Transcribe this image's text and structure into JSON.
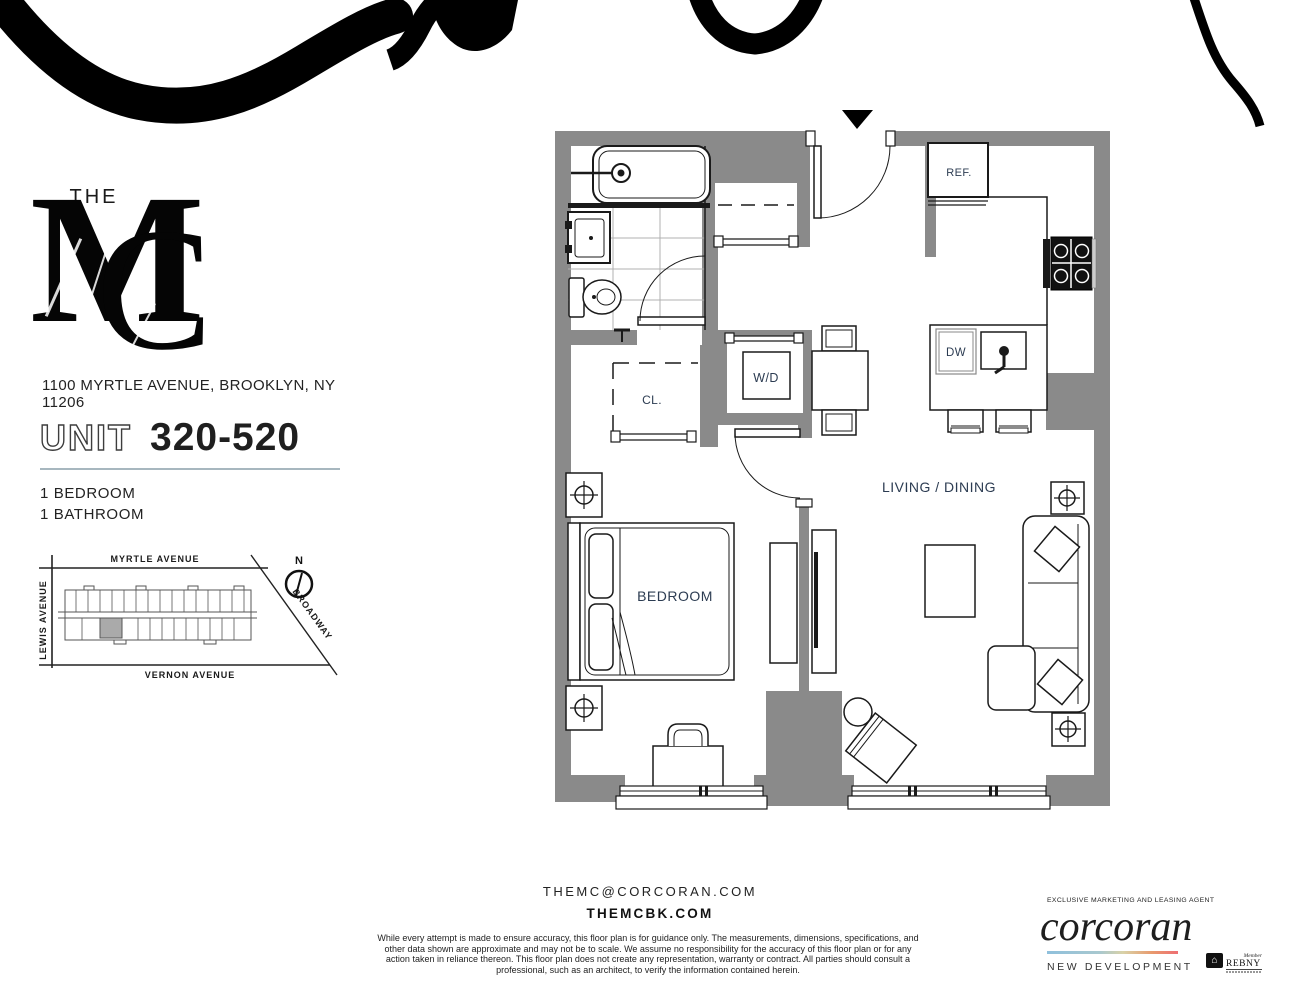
{
  "branding": {
    "the": "THE",
    "monogram_m": "M",
    "monogram_c": "C"
  },
  "address": "1100 MYRTLE AVENUE, BROOKLYN, NY 11206",
  "unit": {
    "label": "UNIT",
    "number": "320-520"
  },
  "specs": {
    "bedrooms": "1 BEDROOM",
    "bathrooms": "1 BATHROOM"
  },
  "map": {
    "street_top": "MYRTLE AVENUE",
    "street_left": "LEWIS AVENUE",
    "street_bottom": "VERNON AVENUE",
    "street_diagonal": "BROADWAY",
    "compass": "N"
  },
  "floorplan": {
    "ref": "REF.",
    "dw": "DW",
    "wd": "W/D",
    "cl": "CL.",
    "bedroom": "BEDROOM",
    "living_dining": "LIVING / DINING"
  },
  "contact": {
    "email": "THEMC@CORCORAN.COM",
    "website": "THEMCBK.COM"
  },
  "disclaimer": "While every attempt is made to ensure accuracy, this floor plan is for guidance only. The measurements, dimensions, specifications, and other data shown are approximate and may not be to scale. We assume no responsibility for the accuracy of this floor plan or for any action taken in reliance thereon. This floor plan does not create any representation, warranty or contract. All parties should consult a professional, such as an architect, to verify the information contained herein.",
  "agent": {
    "tagline": "EXCLUSIVE MARKETING AND LEASING AGENT",
    "brand": "corcoran",
    "division": "NEW DEVELOPMENT",
    "rebny_member": "Member",
    "rebny_name": "REBNY"
  },
  "colors": {
    "wall_gray": "#8a8a8a",
    "label_navy": "#2c3c52",
    "divider": "#a7b7bf",
    "gradient": [
      "#8fc0dc",
      "#d9d2a8",
      "#e89a6d",
      "#ee6e72"
    ]
  }
}
